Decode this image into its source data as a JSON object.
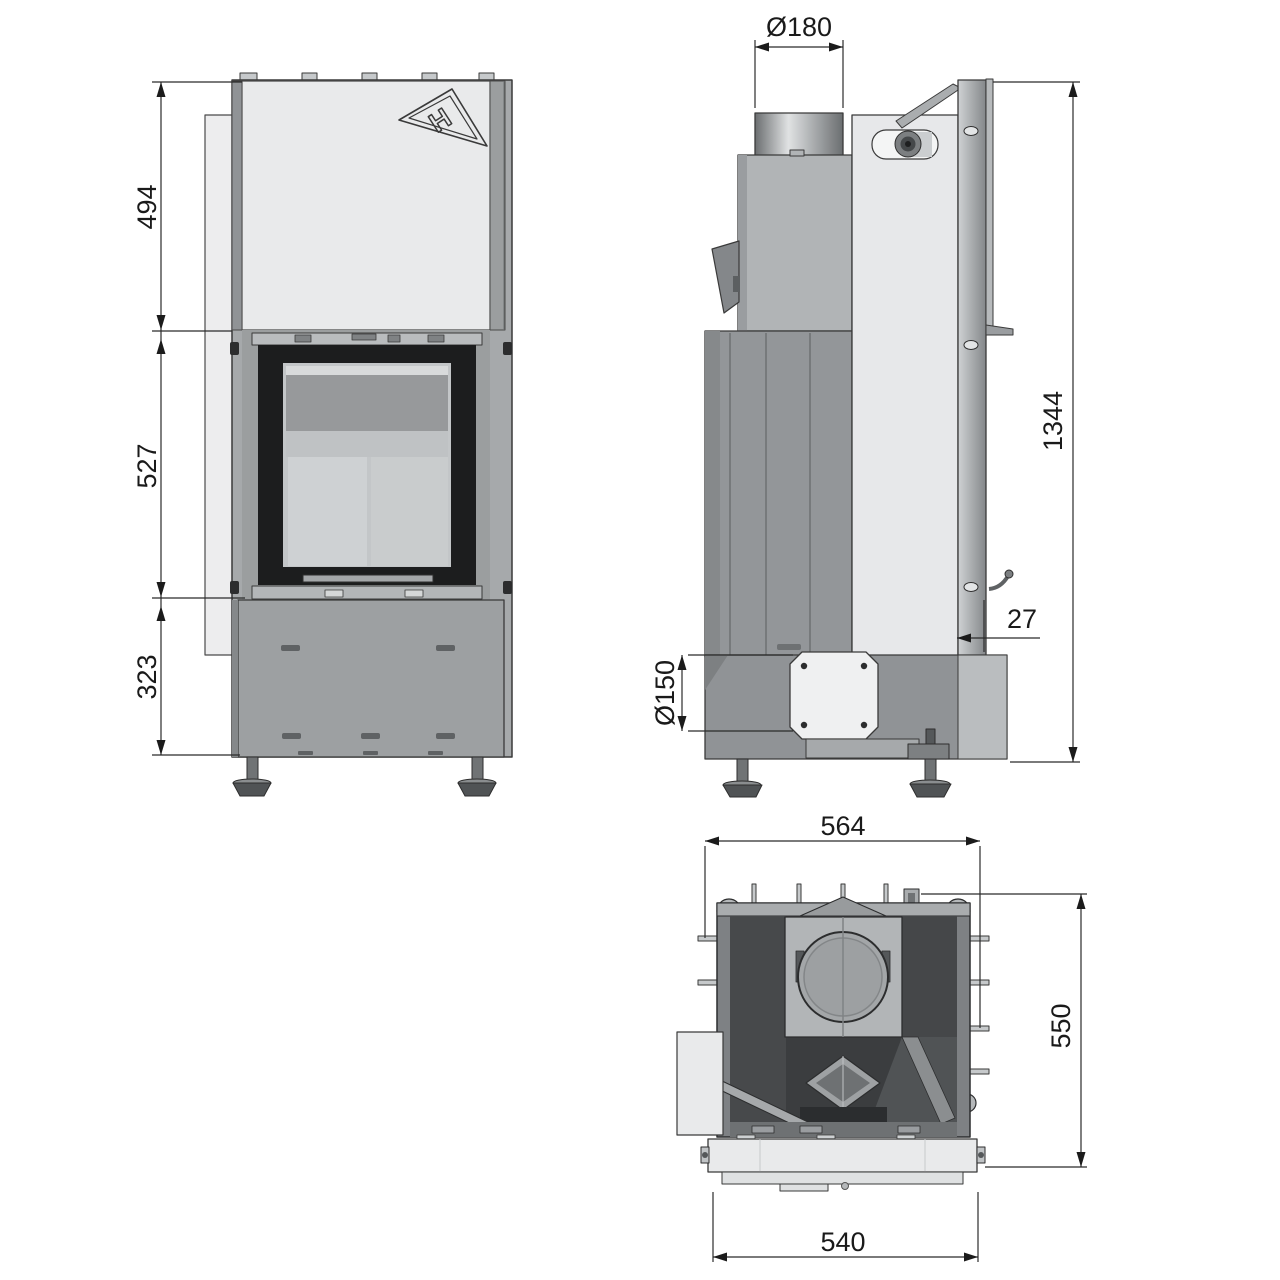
{
  "drawing": {
    "logo_text": "H",
    "views": {
      "front": {
        "dims": {
          "upper_height": "494",
          "glass_height": "527",
          "base_height": "323"
        }
      },
      "side": {
        "dims": {
          "flue_diameter": "Ø180",
          "overall_height": "1344",
          "frame_offset": "27",
          "air_inlet_diameter": "Ø150"
        }
      },
      "top": {
        "dims": {
          "overall_width": "564",
          "overall_depth": "550",
          "front_width": "540"
        }
      }
    },
    "colors": {
      "line": "#2b2b2b",
      "panel_light": "#e9eaeb",
      "body_gray": "#a6a9ab",
      "door_frame_dark": "#1c1d1e",
      "firebox_dark": "#3b3d3f",
      "background": "#ffffff"
    }
  }
}
